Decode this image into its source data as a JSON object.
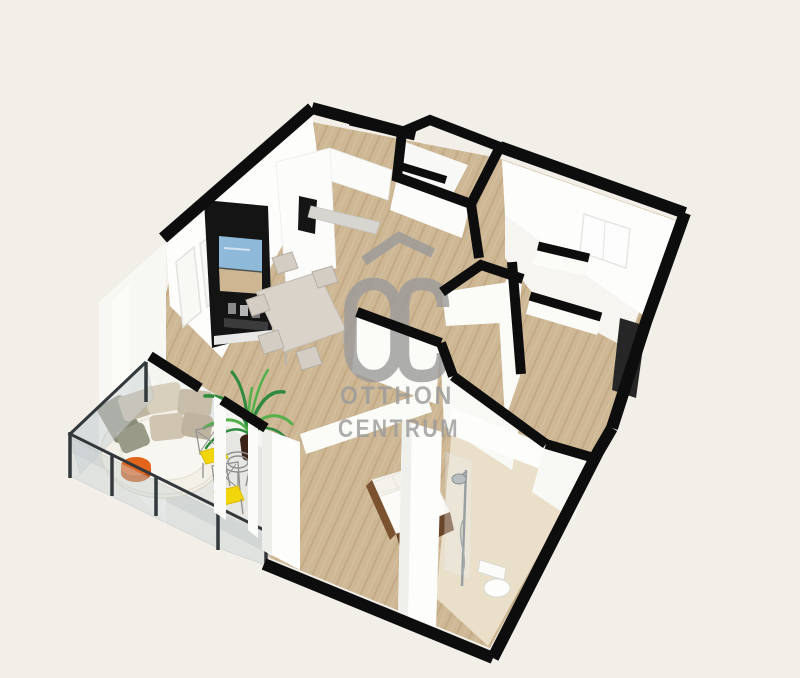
{
  "watermark": {
    "logo_text": "OC",
    "brand_line1": "OTTHON",
    "brand_line2": "CENTRUM"
  },
  "colors": {
    "background": "#f1efe8",
    "wallTop": "#0d0d0d",
    "wallWhite": "#fdfdfc",
    "wallShaded": "#f4f4f1",
    "wood": "#cdb795",
    "woodLine": "#b89a72",
    "tile": "#eadfc9",
    "balconyFloor": "#e6e6e3",
    "glass": "#ccd4d6",
    "railing": "#33383b",
    "watermark": "#9a9a9a",
    "tvPanel": "#141414",
    "screenSky": "#8fb9d9",
    "screenSand": "#cdb691",
    "tableTop": "#d9d3c9",
    "chair": "#d3cdc3",
    "daybed": "#f3f0e8",
    "pillowTaupe": "#c0b5a1",
    "pillowOlive": "#8a8a78",
    "accentOrange": "#e3651c",
    "palmGreen": "#2e8b3d",
    "palmLight": "#53b04a",
    "plantPot": "#3a2316",
    "accentYellow": "#f2d50a",
    "wireGray": "#8f8f8f",
    "bedLinen": "#fcfbf7",
    "bedFrame": "#6b4528",
    "chrome": "#9aa0a2",
    "doorDark": "#262626"
  }
}
